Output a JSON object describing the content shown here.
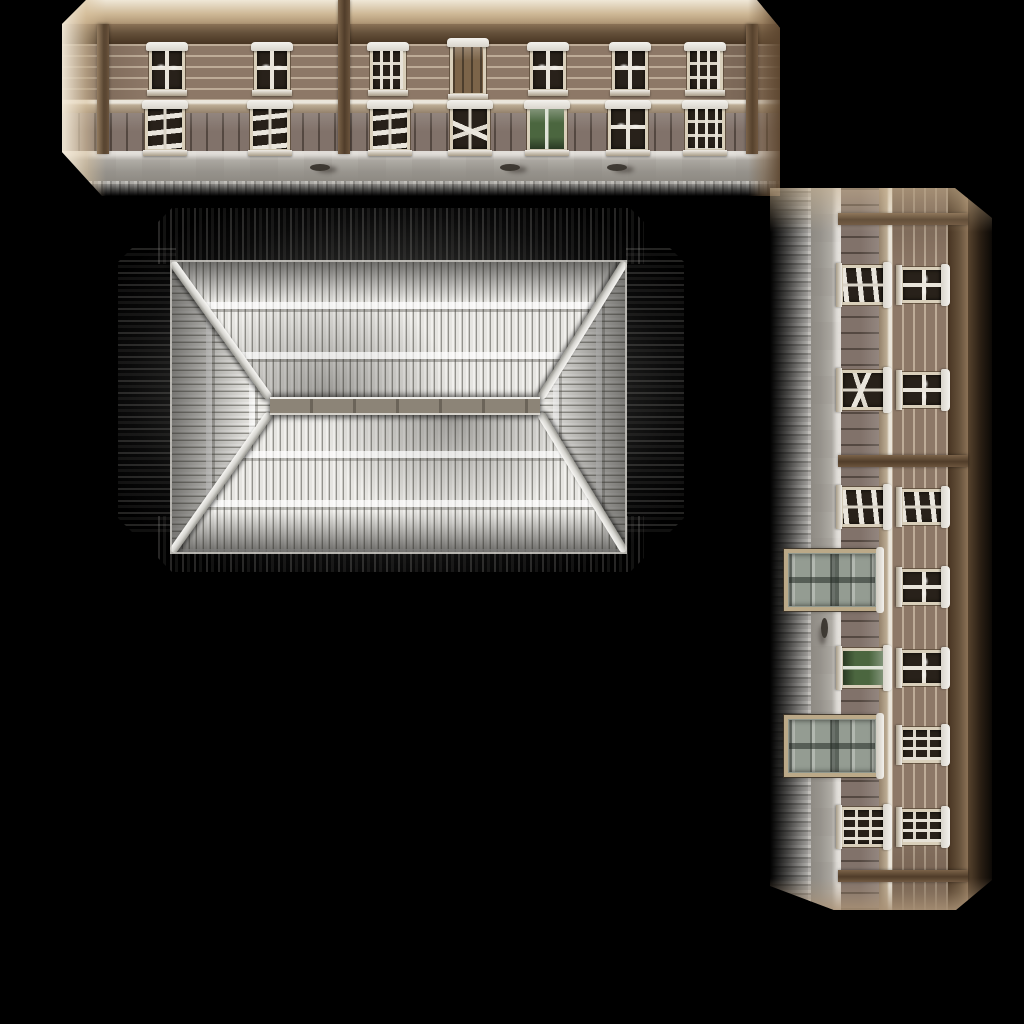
{
  "scene": {
    "background": "#000000",
    "width": 1024,
    "height": 1024
  },
  "palette": {
    "wall_siding": "#8d7867",
    "siding_highlight": "#eee0c9",
    "eaves_beam": "#64503a",
    "lower_wall": "#81726a",
    "sill_band_snow": "#eae5da",
    "foundation_stone": "#9e9a93",
    "snow": "#f4f2ee",
    "window_frame": "#d9cfba",
    "window_pane": "#28211a",
    "green_window": "#4b663f",
    "door_panel": "#949c92",
    "door_frame": "#bba988",
    "roof_snow": "#f1f0ed",
    "roof_streak": "#93928d",
    "ridge_wood": "#8c8477",
    "shadow_halo": "#232322"
  },
  "front_facade": {
    "x": 62,
    "y": 0,
    "length": 718,
    "height": 196,
    "rotated": false,
    "wash": "light",
    "clip": "polygon(24px 0px, 695px 0px, 718px 28px, 718px 196px, 40px 196px, 0px 152px, 0px 24px)",
    "posts": [
      {
        "x": 41,
        "tall": false
      },
      {
        "x": 282,
        "tall": true
      },
      {
        "x": 690,
        "tall": false
      }
    ],
    "upper_windows": [
      {
        "cx": 105,
        "type": "cross"
      },
      {
        "cx": 210,
        "type": "cross"
      },
      {
        "cx": 326,
        "type": "grid"
      },
      {
        "cx": 406,
        "type": "shutter"
      },
      {
        "cx": 486,
        "type": "cross"
      },
      {
        "cx": 568,
        "type": "cross"
      },
      {
        "cx": 643,
        "type": "grid"
      }
    ],
    "lower_windows": [
      {
        "cx": 103,
        "type": "planks"
      },
      {
        "cx": 208,
        "type": "planks"
      },
      {
        "cx": 328,
        "type": "planks"
      },
      {
        "cx": 408,
        "type": "diagonal"
      },
      {
        "cx": 485,
        "type": "green"
      },
      {
        "cx": 566,
        "type": "cross"
      },
      {
        "cx": 643,
        "type": "grid"
      }
    ],
    "doors": [],
    "stains": [
      248,
      438,
      545
    ]
  },
  "side_facade": {
    "x": 770,
    "y": 188,
    "length": 722,
    "height": 222,
    "rotated": true,
    "wash": "dark",
    "clip": "polygon(0px 0px, 185px 0px, 222px 30px, 222px 692px, 186px 722px, 64px 722px, 0px 698px)",
    "posts": [
      {
        "x": 31,
        "tall": false
      },
      {
        "x": 273,
        "tall": false
      },
      {
        "x": 688,
        "tall": false
      }
    ],
    "upper_windows": [
      {
        "cx": 97,
        "type": "cross"
      },
      {
        "cx": 202,
        "type": "cross"
      },
      {
        "cx": 319,
        "type": "planks"
      },
      {
        "cx": 399,
        "type": "cross"
      },
      {
        "cx": 480,
        "type": "cross"
      },
      {
        "cx": 557,
        "type": "grid"
      },
      {
        "cx": 639,
        "type": "grid"
      }
    ],
    "lower_windows": [
      {
        "cx": 97,
        "type": "planks"
      },
      {
        "cx": 202,
        "type": "diagonal"
      },
      {
        "cx": 319,
        "type": "planks"
      },
      {
        "cx": 480,
        "type": "green"
      },
      {
        "cx": 639,
        "type": "grid"
      }
    ],
    "doors": [
      {
        "cx": 392
      },
      {
        "cx": 558
      }
    ],
    "stains": [
      430
    ]
  },
  "roof": {
    "x": 118,
    "y": 208,
    "w": 566,
    "h": 364,
    "clip": "polygon(54px 0px, 512px 0px, 566px 54px, 566px 310px, 512px 364px, 54px 364px, 0px 310px, 0px 54px)",
    "faces": {
      "x": 54,
      "y": 54,
      "w": 453,
      "h": 290
    },
    "ridge": {
      "x": 98,
      "y": 135,
      "w": 270,
      "h": 18
    }
  }
}
